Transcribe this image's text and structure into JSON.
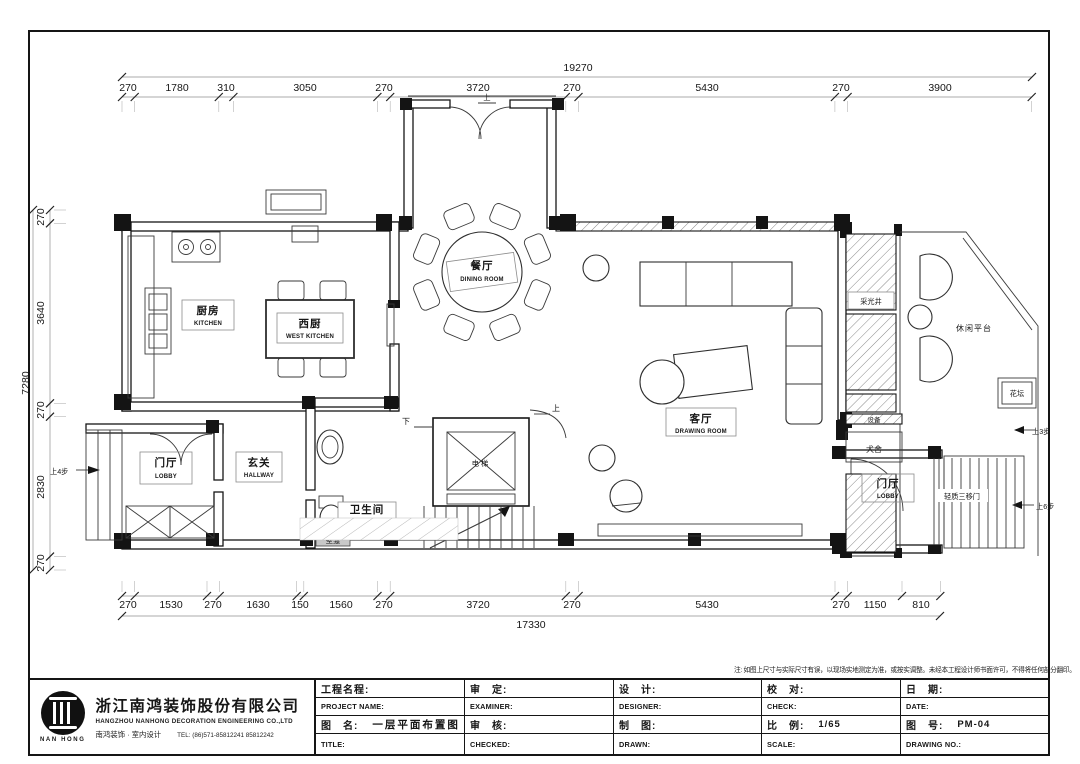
{
  "note": "注: 如图上尺寸与实际尺寸有误，以现场实地测定为准，或按实调整。未经本工程设计师书面许可，不得将任何部分翻印。",
  "dims": {
    "top_total": "19270",
    "top": [
      "270",
      "1780",
      "310",
      "3050",
      "270",
      "3720",
      "270",
      "5430",
      "270",
      "3900"
    ],
    "left_total": "7280",
    "left": [
      "270",
      "3640",
      "270",
      "2830",
      "270"
    ],
    "bottom_total": "17330",
    "bottom": [
      "270",
      "1530",
      "270",
      "1630",
      "150",
      "1560",
      "270",
      "3720",
      "270",
      "5430",
      "270",
      "1150",
      "810"
    ]
  },
  "labels": {
    "kitchen_zh": "厨房",
    "kitchen_en": "KITCHEN",
    "west_kitchen_zh": "西厨",
    "west_kitchen_en": "WEST KITCHEN",
    "dining_zh": "餐厅",
    "dining_en": "DINING ROOM",
    "drawing_zh": "客厅",
    "drawing_en": "DRAWING ROOM",
    "lobby_zh": "门厅",
    "lobby_en": "LOBBY",
    "hallway_zh": "玄关",
    "hallway_en": "HALLWAY",
    "toilet_zh": "卫生间",
    "toilet_en": "TOILET",
    "elevator": "电梯",
    "light_well": "采光井",
    "leisure_platform": "休闲平台",
    "flower_bed": "花坛",
    "dog_house": "犬舍",
    "equipment": "设备",
    "niche": "壁龛",
    "sliding_door": "轻质三移门",
    "up": "上",
    "down": "下",
    "up3": "上3步",
    "up4": "上4步",
    "up6": "上6步"
  },
  "titleblock": {
    "company": {
      "logo_text": "NAN HONG",
      "name_zh": "浙江南鸿装饰股份有限公司",
      "name_en": "HANGZHOU NANHONG DECORATION ENGINEERING CO.,LTD",
      "sub": "南鸿装饰 · 室内设计",
      "tel": "TEL: (86)571-85812241 85812242"
    },
    "row1": [
      "工程名程:",
      "审　定:",
      "设　计:",
      "校　对:",
      "日　期:"
    ],
    "row2": [
      "PROJECT NAME:",
      "EXAMINER:",
      "DESIGNER:",
      "CHECK:",
      "DATE:"
    ],
    "row3_labels": [
      "图　名:",
      "审　核:",
      "制　图:",
      "比　例:",
      "图　号:"
    ],
    "row3_values": [
      "一层平面布置图",
      "",
      "",
      "1/65",
      "PM-04"
    ],
    "row4": [
      "TITLE:",
      "CHECKED:",
      "DRAWN:",
      "SCALE:",
      "DRAWING NO.:"
    ]
  }
}
